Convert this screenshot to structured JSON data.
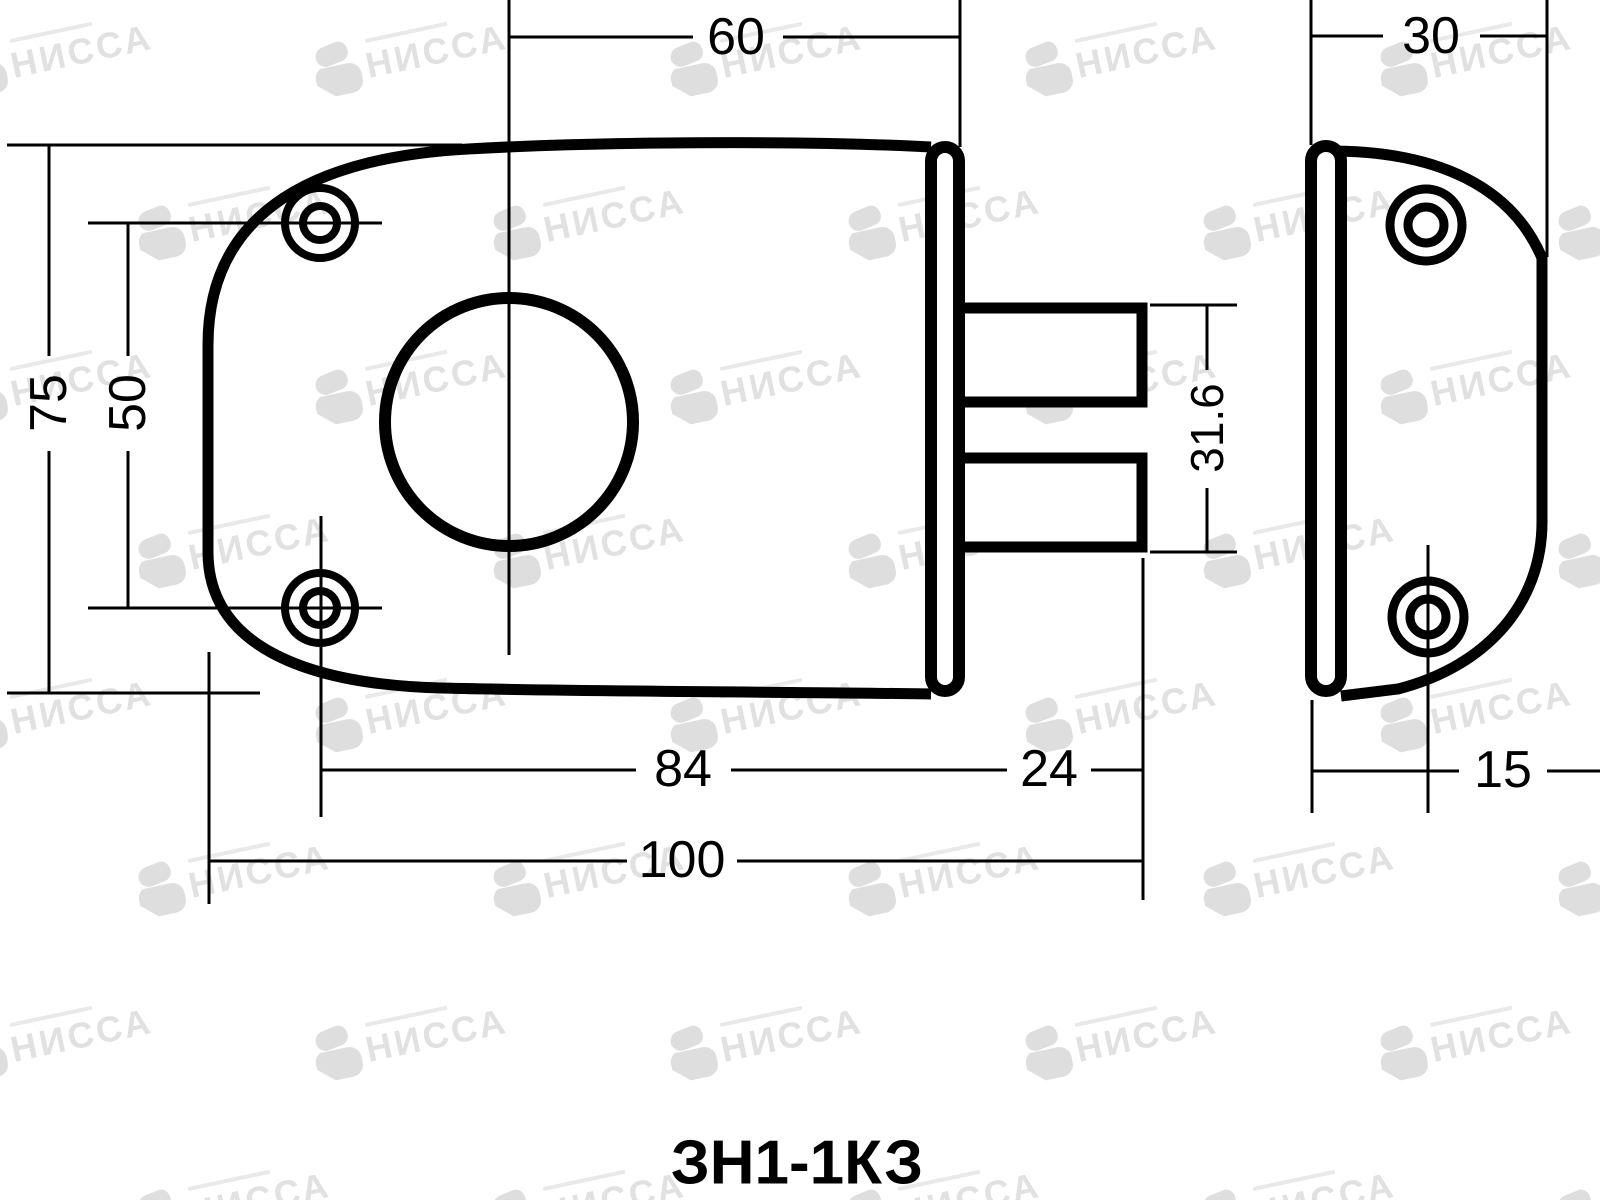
{
  "page": {
    "background_color": "#ffffff",
    "line_color": "#000000"
  },
  "watermark": {
    "text": "НИССА",
    "color": "#e1e1e1"
  },
  "caption": {
    "model": "ЗН1-1КЗ"
  },
  "dimensions": {
    "front_top_width": "60",
    "plate_top_width": "30",
    "body_height": "75",
    "screw_spacing": "50",
    "bolt_span": "31.6",
    "screw_to_face": "84",
    "bolt_length": "24",
    "overall_length": "100",
    "plate_screw_offset": "15"
  }
}
